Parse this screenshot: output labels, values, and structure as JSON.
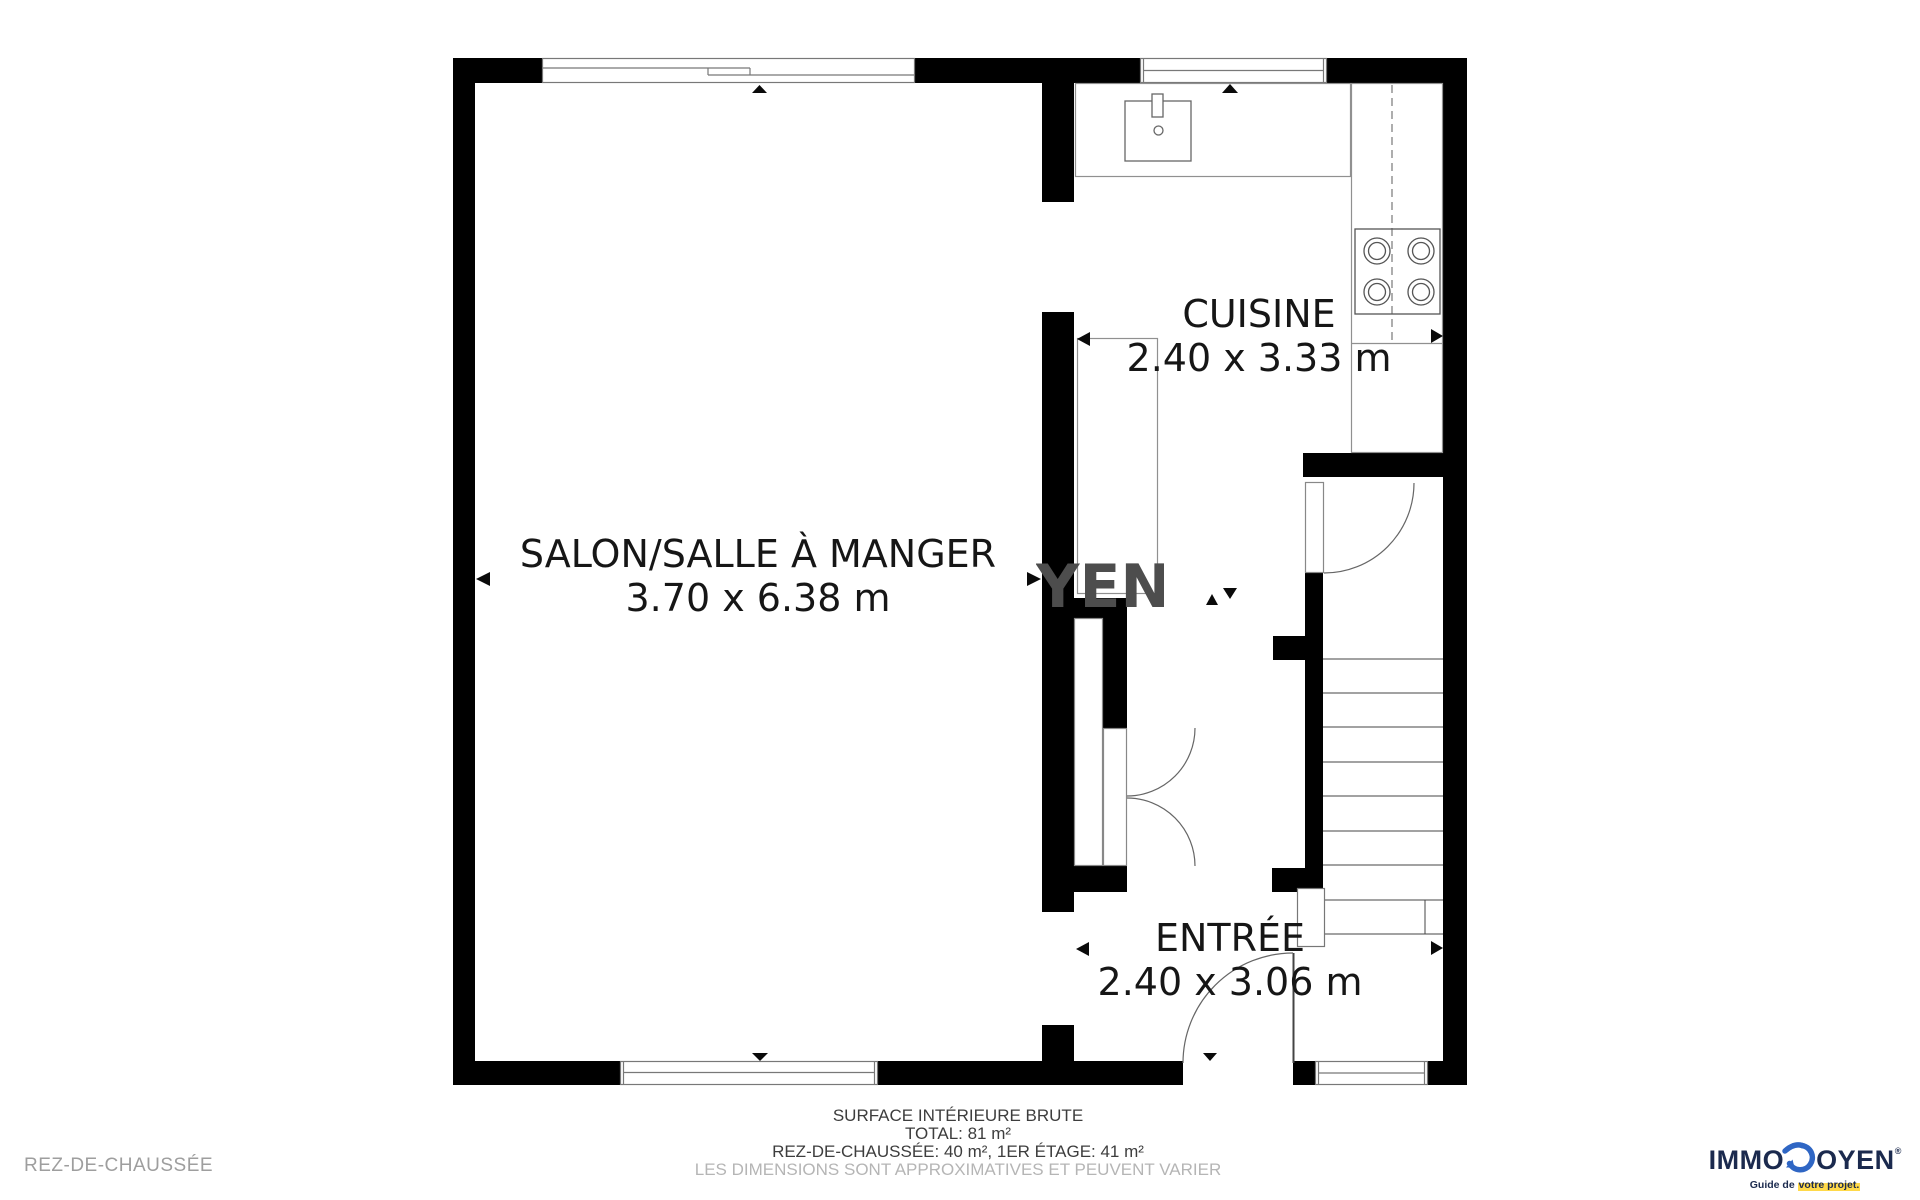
{
  "plan": {
    "watermark": "YEN",
    "rooms": [
      {
        "name": "SALON/SALLE À MANGER",
        "dims": "3.70 x 6.38 m"
      },
      {
        "name": "CUISINE",
        "dims": "2.40 x 3.33 m"
      },
      {
        "name": "ENTRÉE",
        "dims": "2.40 x 3.06 m"
      }
    ]
  },
  "footer": {
    "surface_title": "SURFACE INTÉRIEURE BRUTE",
    "total": "TOTAL: 81 m²",
    "breakdown": "REZ-DE-CHAUSSÉE: 40 m², 1ER ÉTAGE: 41 m²",
    "disclaimer": "LES DIMENSIONS SONT APPROXIMATIVES ET PEUVENT VARIER",
    "floor_label": "REZ-DE-CHAUSSÉE"
  },
  "logo": {
    "name_prefix": "IMMO",
    "name_suffix": "OYEN",
    "registered": "®",
    "tagline_prefix": "Guide de ",
    "tagline_highlight": "votre projet."
  },
  "colors": {
    "wall": "#000000",
    "logo_navy": "#1b2a4e",
    "logo_blue": "#2f66c4",
    "highlight": "#ffd94a",
    "disclaimer_gray": "#b5b5b5"
  }
}
